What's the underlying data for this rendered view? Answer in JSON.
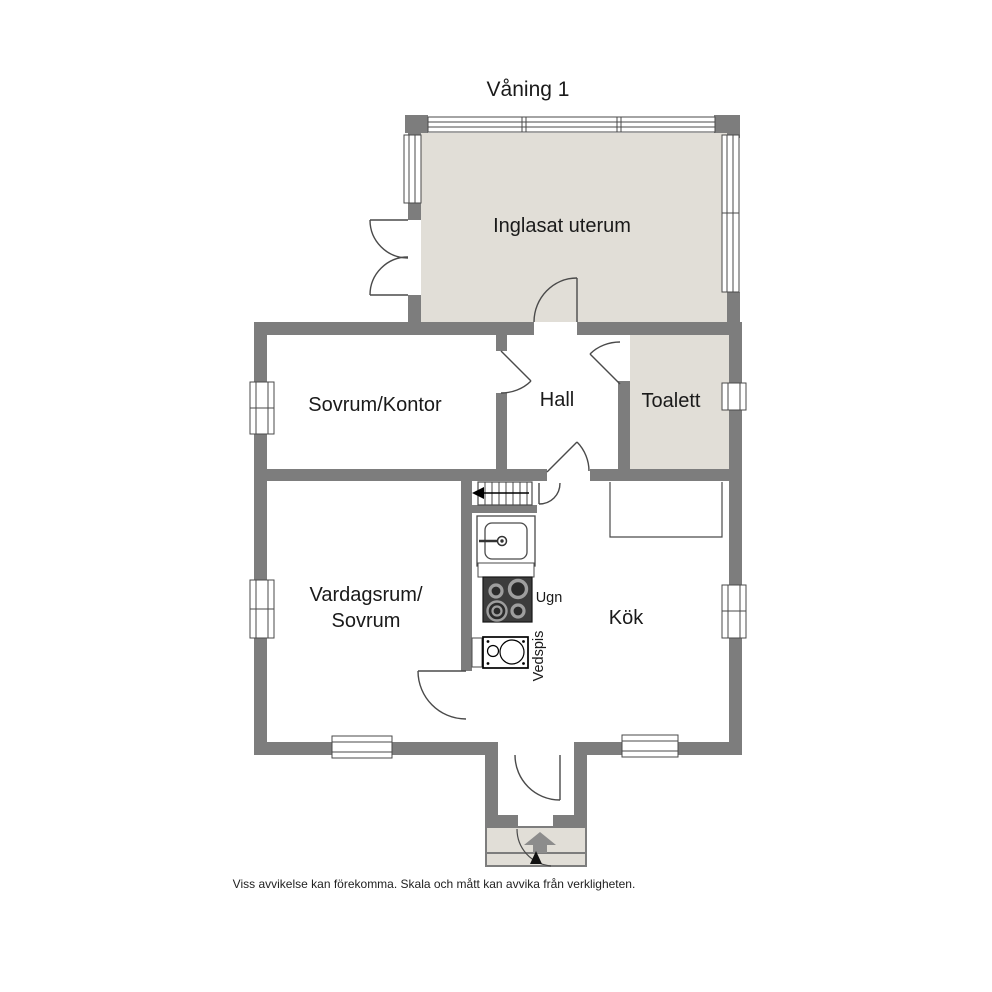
{
  "title": "Våning 1",
  "rooms": {
    "uterum": "Inglasat uterum",
    "sovrum_kontor": "Sovrum/Kontor",
    "hall": "Hall",
    "toalett": "Toalett",
    "vardagsrum_line1": "Vardagsrum/",
    "vardagsrum_line2": "Sovrum",
    "kok": "Kök"
  },
  "fixtures": {
    "ugn": "Ugn",
    "vedspis": "Vedspis"
  },
  "footer": "Viss avvikelse kan förekomma. Skala och mått kan avvika från verkligheten.",
  "icons": {
    "entrance_arrow": "up-arrow-entrance",
    "stairs_arrow": "left-arrow-stairs-down"
  },
  "colors": {
    "wall": "#7d7d7d",
    "floor_highlight": "#e1ded7",
    "outline": "#4a4a4a",
    "background": "#ffffff",
    "stove": "#3c3c3c"
  }
}
